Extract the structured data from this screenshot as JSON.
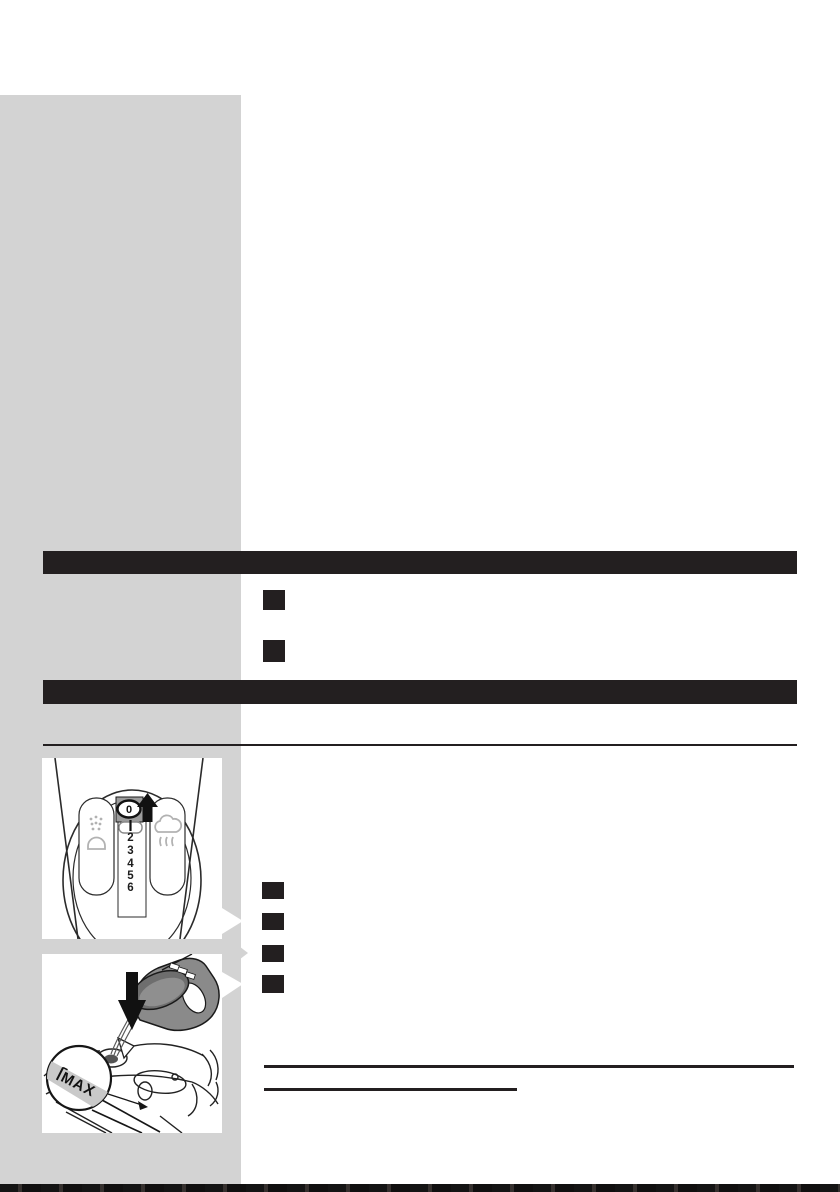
{
  "figure_dial": {
    "selected_setting": "0",
    "scale_numbers": [
      "2",
      "3",
      "4",
      "5",
      "6"
    ]
  },
  "figure_fill": {
    "max_label": "MAX"
  },
  "colors": {
    "sidebar_gray": "#d3d3d3",
    "ink_black": "#231f20",
    "cup_gray": "#8a8a8a",
    "cup_rim_gray": "#6e6e6e",
    "cup_rim_inner_gray": "#8f8f8f",
    "knob_gray": "#9c9c9c",
    "icon_gray": "#b2b2b2",
    "max_band_gray": "#c9c9c9",
    "stream_gray": "#5a5a5a"
  }
}
